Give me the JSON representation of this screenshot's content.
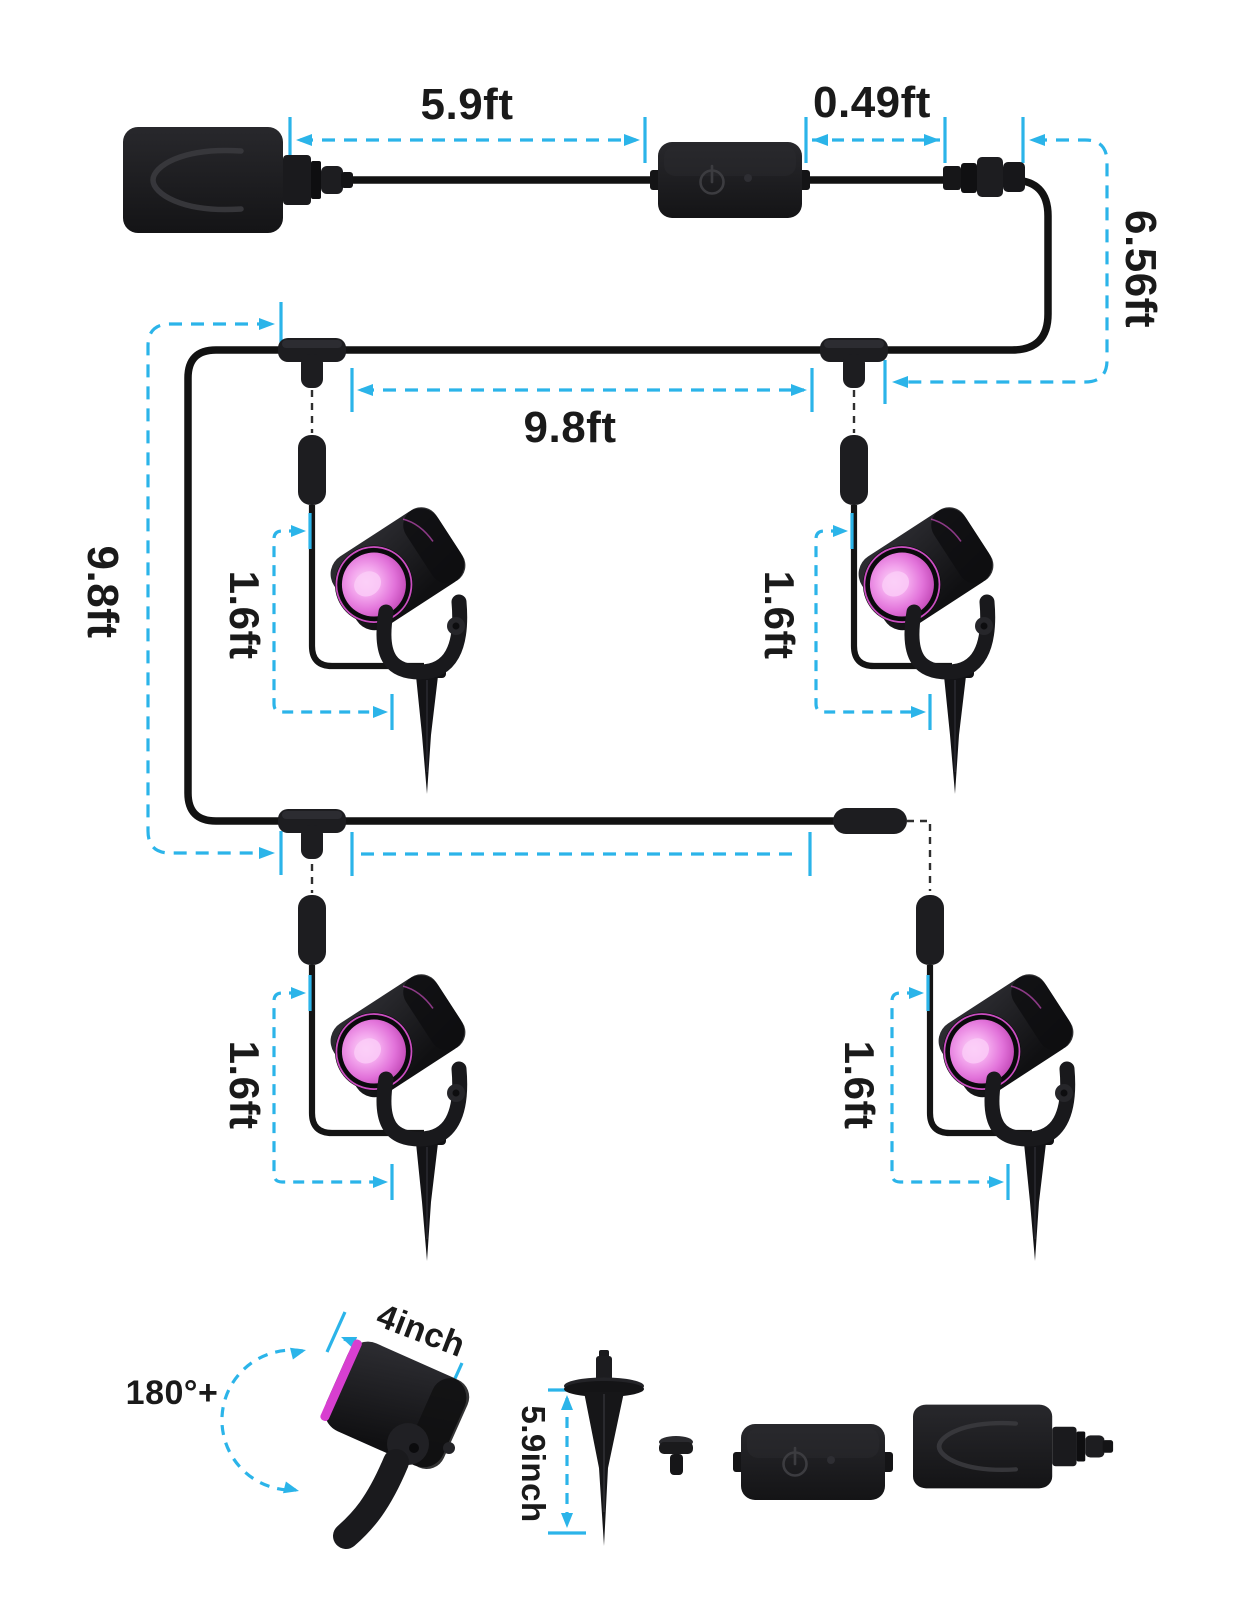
{
  "labels": {
    "adapter_to_controller": "5.9ft",
    "controller_to_connector": "0.49ft",
    "connector_to_tee": "6.56ft",
    "tee_spacing": "9.8ft",
    "side_run": "9.8ft",
    "drop1": "1.6ft",
    "drop2": "1.6ft",
    "drop3": "1.6ft",
    "drop4": "1.6ft",
    "rotation_range": "180°+",
    "head_length": "4inch",
    "stake_length": "5.9inch"
  },
  "colors": {
    "background": "#ffffff",
    "dimension": "#2bb4e9",
    "cable": "#121212",
    "device": "#1c1c1f",
    "lens_pink": "#e273da",
    "label_text": "#1a1a1a"
  },
  "icons": {
    "controller_power": "power-icon"
  }
}
